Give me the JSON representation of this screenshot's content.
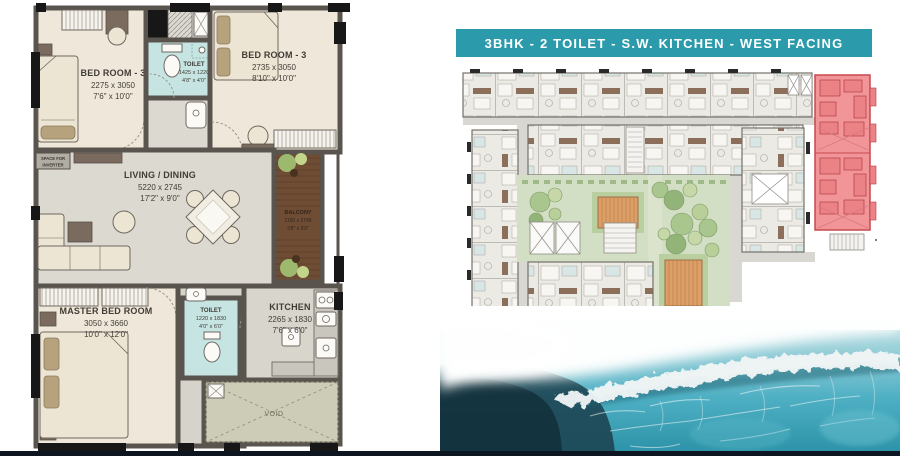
{
  "header": {
    "title": "3BHK - 2 TOILET - S.W. KITCHEN - WEST FACING"
  },
  "floor_plan": {
    "rooms": [
      {
        "id": "bedroom-3-top-left",
        "name": "BED ROOM - 3",
        "dim_mm": "2275 x 3050",
        "dim_ft": "7'6\" x 10'0\""
      },
      {
        "id": "toilet-top",
        "name": "TOILET",
        "dim_mm": "1425 x 1220",
        "dim_ft": "4'8\" x 4'0\""
      },
      {
        "id": "bedroom-3-top-right",
        "name": "BED ROOM - 3",
        "dim_mm": "2735 x 3050",
        "dim_ft": "8'10\" x 10'0\""
      },
      {
        "id": "living-dining",
        "name": "LIVING / DINING",
        "dim_mm": "5220 x 2745",
        "dim_ft": "17'2\" x 9'0\""
      },
      {
        "id": "balcony",
        "name": "BALCONY",
        "dim_mm": "1100 x 2745",
        "dim_ft": "3'8\" x 9'0\""
      },
      {
        "id": "master-bedroom",
        "name": "MASTER BED ROOM",
        "dim_mm": "3050 x 3660",
        "dim_ft": "10'0\" x 12'0\""
      },
      {
        "id": "toilet-bottom",
        "name": "TOILET",
        "dim_mm": "1220 x 1830",
        "dim_ft": "4'0\" x 6'0\""
      },
      {
        "id": "kitchen",
        "name": "KITCHEN",
        "dim_mm": "2265 x 1830",
        "dim_ft": "7'6\" x 6'0\""
      }
    ],
    "labels": {
      "void": "VOID",
      "inverter_line1": "SPACE FOR",
      "inverter_line2": "INVERTER"
    }
  },
  "colors": {
    "header_bg": "#2B9BAC",
    "header_text": "#FFFFFF",
    "wall": "#59544E",
    "floor_cream": "#EFE8DA",
    "floor_gray": "#DCD9D1",
    "toilet_teal": "#C6E4E2",
    "balcony_wood": "#6F4C34",
    "void_green": "#CDCDB7",
    "highlight_red": "#F29598",
    "courtyard_green": "#D2DFC4",
    "deck_tan": "#DD9F66",
    "ocean_teal": "#2D93A8",
    "bottom_bar": "#0D1520"
  }
}
